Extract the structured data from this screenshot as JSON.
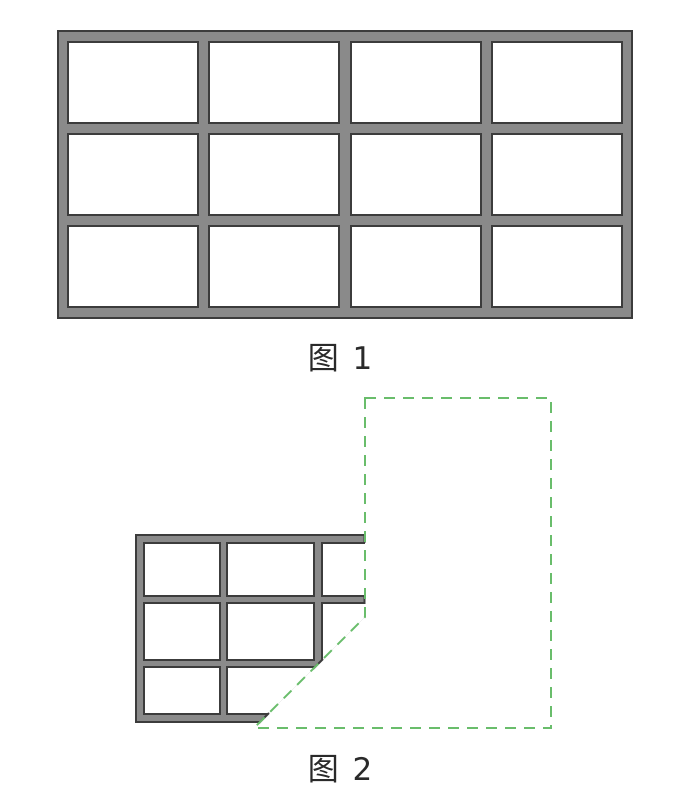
{
  "page": {
    "background_color": "#ffffff"
  },
  "figure1": {
    "caption": "图 1",
    "window_grid": {
      "columns": 4,
      "rows": 3,
      "panes": 12
    },
    "colors": {
      "frame_fill": "#8a8a8a",
      "frame_outline": "#3c3c3c",
      "pane_fill": "#ffffff"
    }
  },
  "figure2": {
    "caption": "图 2",
    "window_grid": {
      "columns_visible": 3,
      "rows": 3,
      "cut": "clipped on the right edge and along a 45-degree diagonal at the lower right"
    },
    "colors": {
      "frame_fill": "#8a8a8a",
      "frame_outline": "#3c3c3c",
      "pane_fill": "#ffffff"
    },
    "dashed_shape": {
      "type": "pentagon-outline",
      "color": "#69bd6b"
    }
  }
}
